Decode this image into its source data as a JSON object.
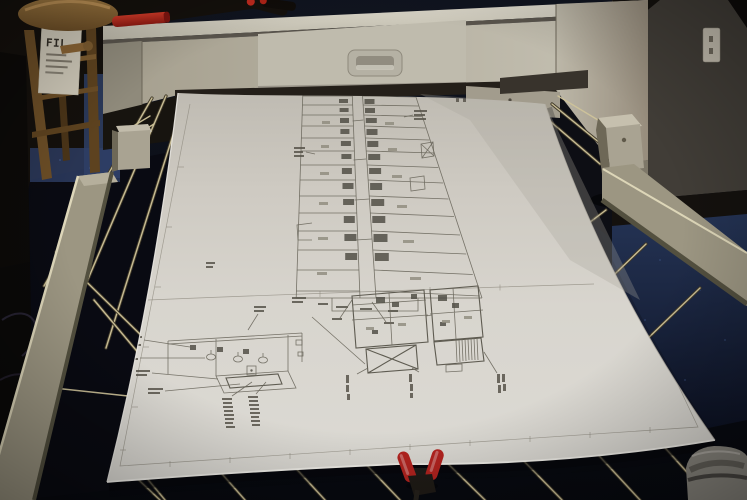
{
  "sign": {
    "text": "FIL"
  },
  "colors": {
    "carpet_top": "#243354",
    "carpet_bottom": "#0c1122",
    "carpet_blue_patch": "#2e3f66",
    "wall_dark": "#14100c",
    "wall_gray": "#413d37",
    "baseboard": "#14110e",
    "printer_body": "#b2ad9f",
    "printer_top": "#d2cec2",
    "printer_panel": "#bfbbad",
    "printer_slot": "#38332c",
    "paper": "#d7d4cd",
    "ink": "#6a675c",
    "ink_dark": "#45423a",
    "rail": "#9c9682",
    "rail_highlight": "#ddd6b8",
    "rod": "#cfc39a",
    "post": "#a9a392",
    "clamp_red": "#b4231f",
    "marker_black": "#15110d",
    "marker_red": "#bf2a1e",
    "wood": "#8a6434",
    "sign_bg": "#cfc9b9",
    "sign_text_color": "#332e26",
    "outlet": "#c2bcae",
    "shoe": "#8b8880"
  }
}
